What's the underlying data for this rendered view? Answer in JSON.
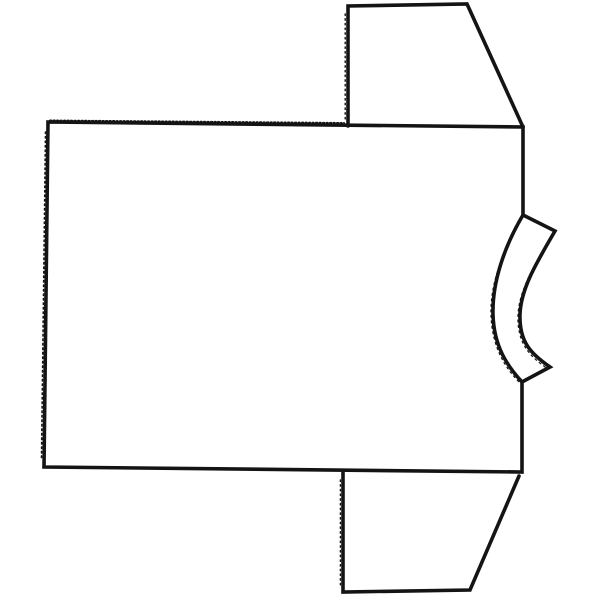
{
  "canvas": {
    "width": 600,
    "height": 600,
    "background": "#ffffff"
  },
  "drawing": {
    "subject": "t-shirt outline sketch rotated sideways, collar at right",
    "stroke_color": "#141414",
    "default_stroke_width": 3.6,
    "shapes": [
      {
        "id": "shirt-body-outline",
        "d": "M 48,122 L 523,127 L 523,215 C 504,247 492,283 493,315 C 494,346 507,366 522,382 L 522,472 L 44,467 Z",
        "width": 3.6,
        "dash": ""
      },
      {
        "id": "collar-band",
        "d": "M 523,215 L 555,231 C 537,262 521,288 520,314 C 519,342 531,354 550,367 L 522,382",
        "width": 3.6,
        "dash": ""
      },
      {
        "id": "top-sleeve",
        "d": "M 348,126 L 348,6 L 467,4 L 523,127",
        "width": 3.6,
        "dash": ""
      },
      {
        "id": "bottom-sleeve",
        "d": "M 343,471 L 343,592 L 470,590 L 519,476",
        "width": 3.6,
        "dash": ""
      },
      {
        "id": "shoulder-serration-texture",
        "d": "M 50,120.5 L 344,123",
        "width": 2,
        "dash": "1.3 2.2"
      },
      {
        "id": "left-hem-dot-texture",
        "d": "M 45.5,132 L 41.5,458",
        "width": 1.6,
        "dash": "1.5 3"
      },
      {
        "id": "top-sleeve-edge-dot-texture",
        "d": "M 345.2,14 L 345.2,120",
        "width": 1.4,
        "dash": "1.5 3.2"
      },
      {
        "id": "bottom-sleeve-edge-dot-texture",
        "d": "M 340.4,480 L 340.4,586",
        "width": 1.4,
        "dash": "1.5 3.2"
      },
      {
        "id": "collar-inner-rough-texture",
        "d": "M 520,222 C 502,252 490,285 491,315 C 492,347 505,368 520,383",
        "width": 1.2,
        "dash": "2 3.5"
      },
      {
        "id": "collar-outer-rough-texture",
        "d": "M 552,234 C 535,264 519,290 518,315 C 517,343 529,356 548,369",
        "width": 1.2,
        "dash": "2 3.5"
      }
    ]
  }
}
